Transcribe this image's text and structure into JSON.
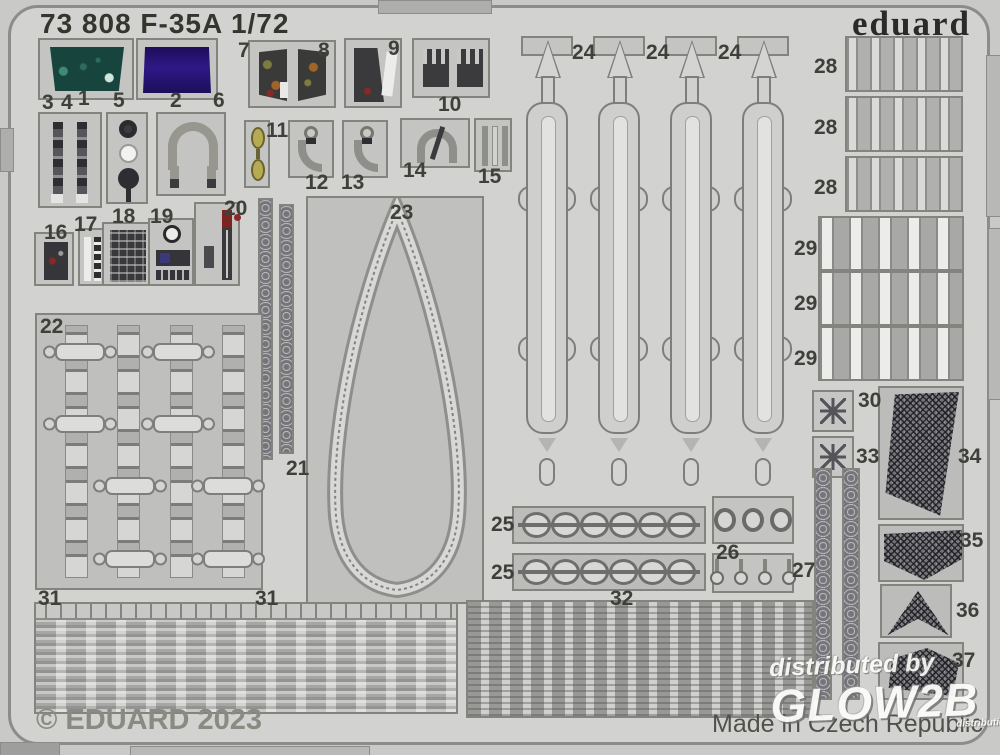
{
  "header": {
    "title": "73 808 F-35A 1/72",
    "brand": "eduard"
  },
  "labels": {
    "1": "1",
    "2": "2",
    "3": "3",
    "4": "4",
    "5": "5",
    "6": "6",
    "7": "7",
    "8": "8",
    "9": "9",
    "10": "10",
    "11": "11",
    "12": "12",
    "13": "13",
    "14": "14",
    "15": "15",
    "16": "16",
    "17": "17",
    "18": "18",
    "19": "19",
    "20": "20",
    "21": "21",
    "22": "22",
    "23": "23",
    "24": "24",
    "25": "25",
    "26": "26",
    "27": "27",
    "28": "28",
    "29": "29",
    "30": "30",
    "31": "31",
    "32": "32",
    "33": "33",
    "34": "34",
    "35": "35",
    "36": "36",
    "37": "37"
  },
  "footer": {
    "copyright": "© EDUARD 2023",
    "made_in": "Made in Czech Republic"
  },
  "watermark": {
    "line1": "distributed by",
    "line2": "GLOW2B",
    "line3": "distribution"
  },
  "colors": {
    "display_purple": "#2c1480",
    "panel_teal": "#17453d",
    "belt_yellow": "#b5ab51",
    "accent_red": "#7c2422",
    "sheet_gray": "#d2d2d0"
  }
}
